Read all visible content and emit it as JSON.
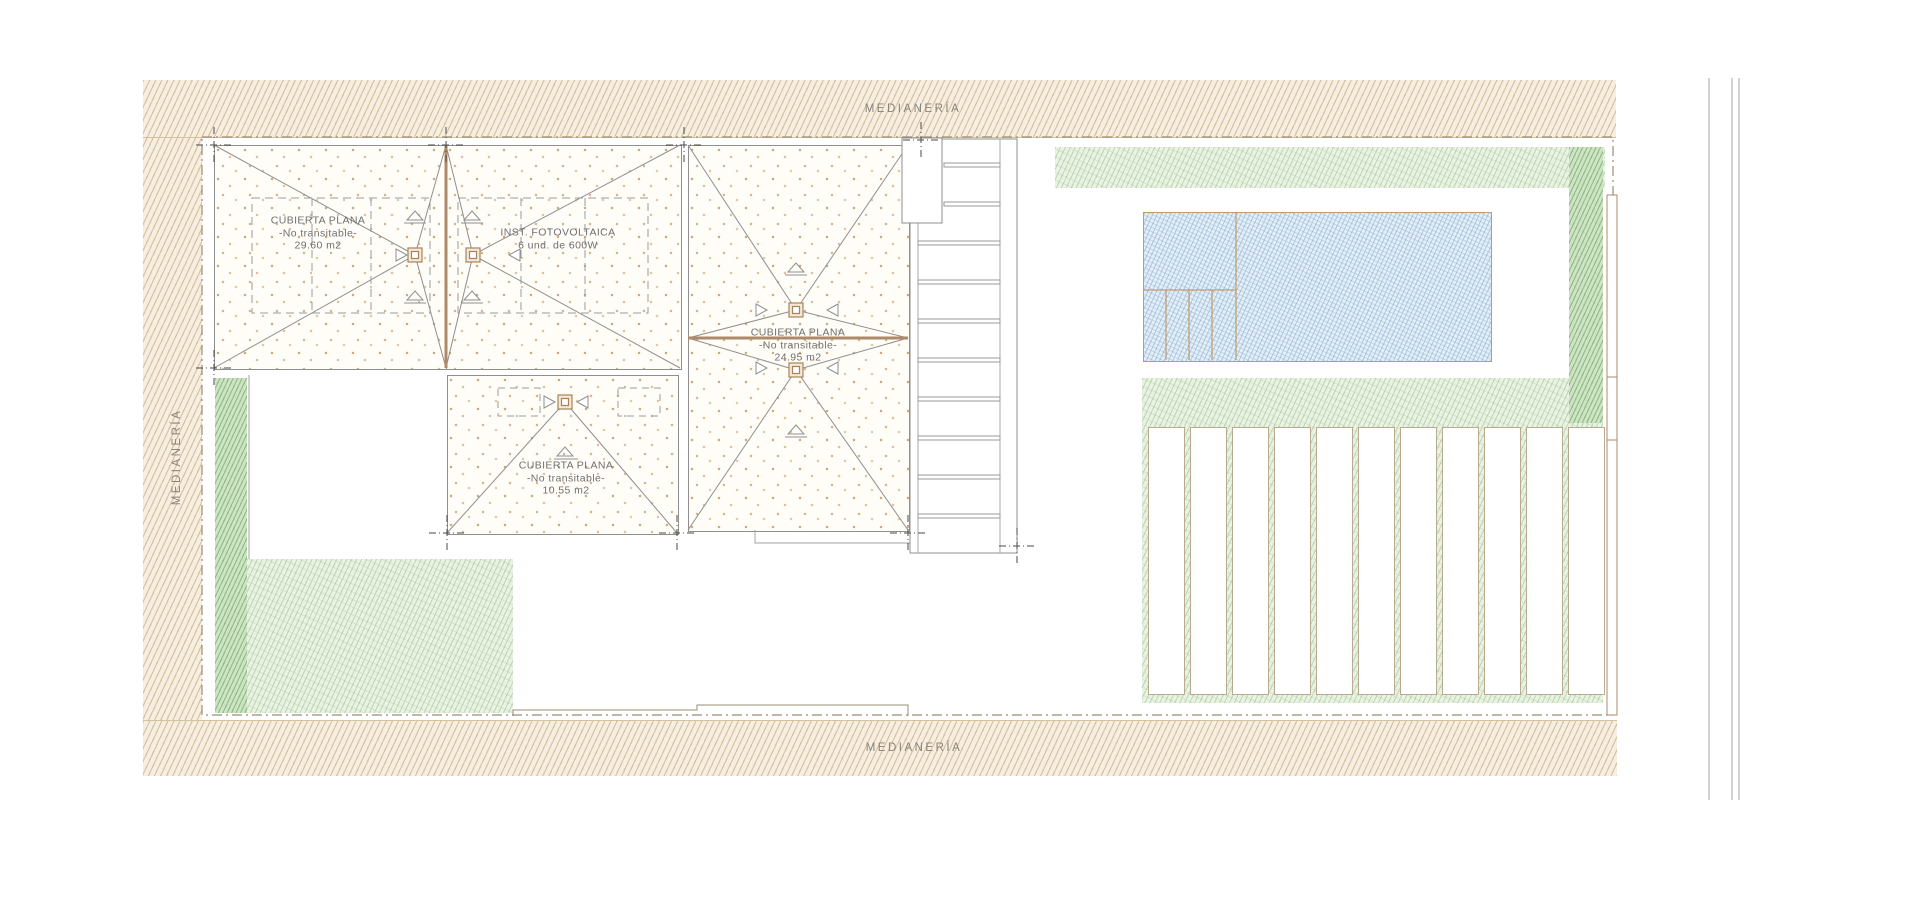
{
  "labels": {
    "party_wall_top": "MEDIANERÍA",
    "party_wall_bottom": "MEDIANERÍA",
    "party_wall_left": "MEDIANERÍA"
  },
  "roofs": {
    "roof_a": {
      "name": "CUBIERTA PLANA",
      "sub": "-No transitable-",
      "area": "29.60 m2"
    },
    "roof_b": {
      "name": "INST. FOTOVOLTAICA",
      "sub": "6 und. de 600W"
    },
    "roof_c": {
      "name": "CUBIERTA PLANA",
      "sub": "-No transitable-",
      "area": "24.95 m2"
    },
    "roof_d": {
      "name": "CUBIERTA PLANA",
      "sub": "-No transitable-",
      "area": "10.55 m2"
    }
  },
  "colors": {
    "party_wall_hatch": "#b99463",
    "garden_green": "#86b57c",
    "pool_blue": "#7aa6ce",
    "roof_line": "#8f8f8f",
    "ridge_tan": "#b08968",
    "boundary_dash": "#9b8d75"
  }
}
